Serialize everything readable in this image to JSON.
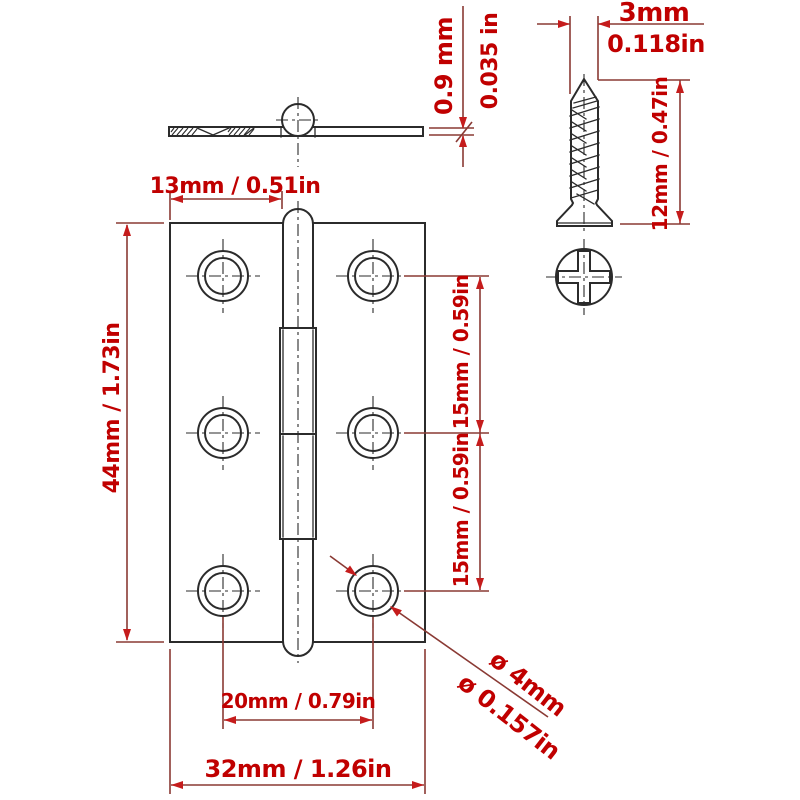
{
  "colors": {
    "background": "#ffffff",
    "label_red": "#c00000",
    "dimension_line_red": "#8a3a34",
    "arrow_red": "#c51c1c",
    "linework_black": "#2b2b2b"
  },
  "labels": {
    "thickness_mm": "0.9 mm",
    "thickness_in": "0.035 in",
    "screw_diameter_mm": "3mm",
    "screw_diameter_in": "0.118in",
    "screw_length": "12mm / 0.47in",
    "leaf_width": "13mm / 0.51in",
    "hinge_height": "44mm / 1.73in",
    "hole_spacing_upper": "15mm / 0.59in",
    "hole_spacing_lower": "15mm / 0.59in",
    "hole_span": "20mm / 0.79in",
    "hinge_width": "32mm / 1.26in",
    "hole_diameter_mm": "ø 4mm",
    "hole_diameter_in": "ø 0.157in"
  }
}
